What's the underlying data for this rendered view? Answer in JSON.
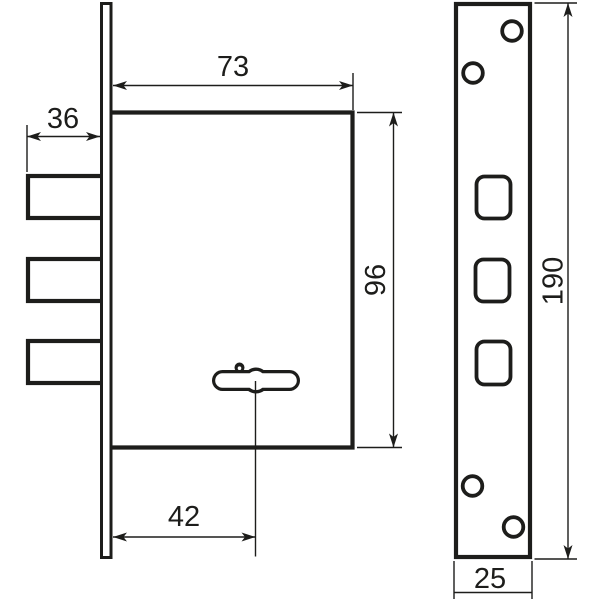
{
  "drawing": {
    "background": "#ffffff",
    "line_color": "#1d1d1b",
    "labels": {
      "case_width": "73",
      "bolt_length": "36",
      "case_height": "96",
      "keyhole_offset": "42",
      "faceplate_height": "190",
      "faceplate_width": "25"
    }
  }
}
